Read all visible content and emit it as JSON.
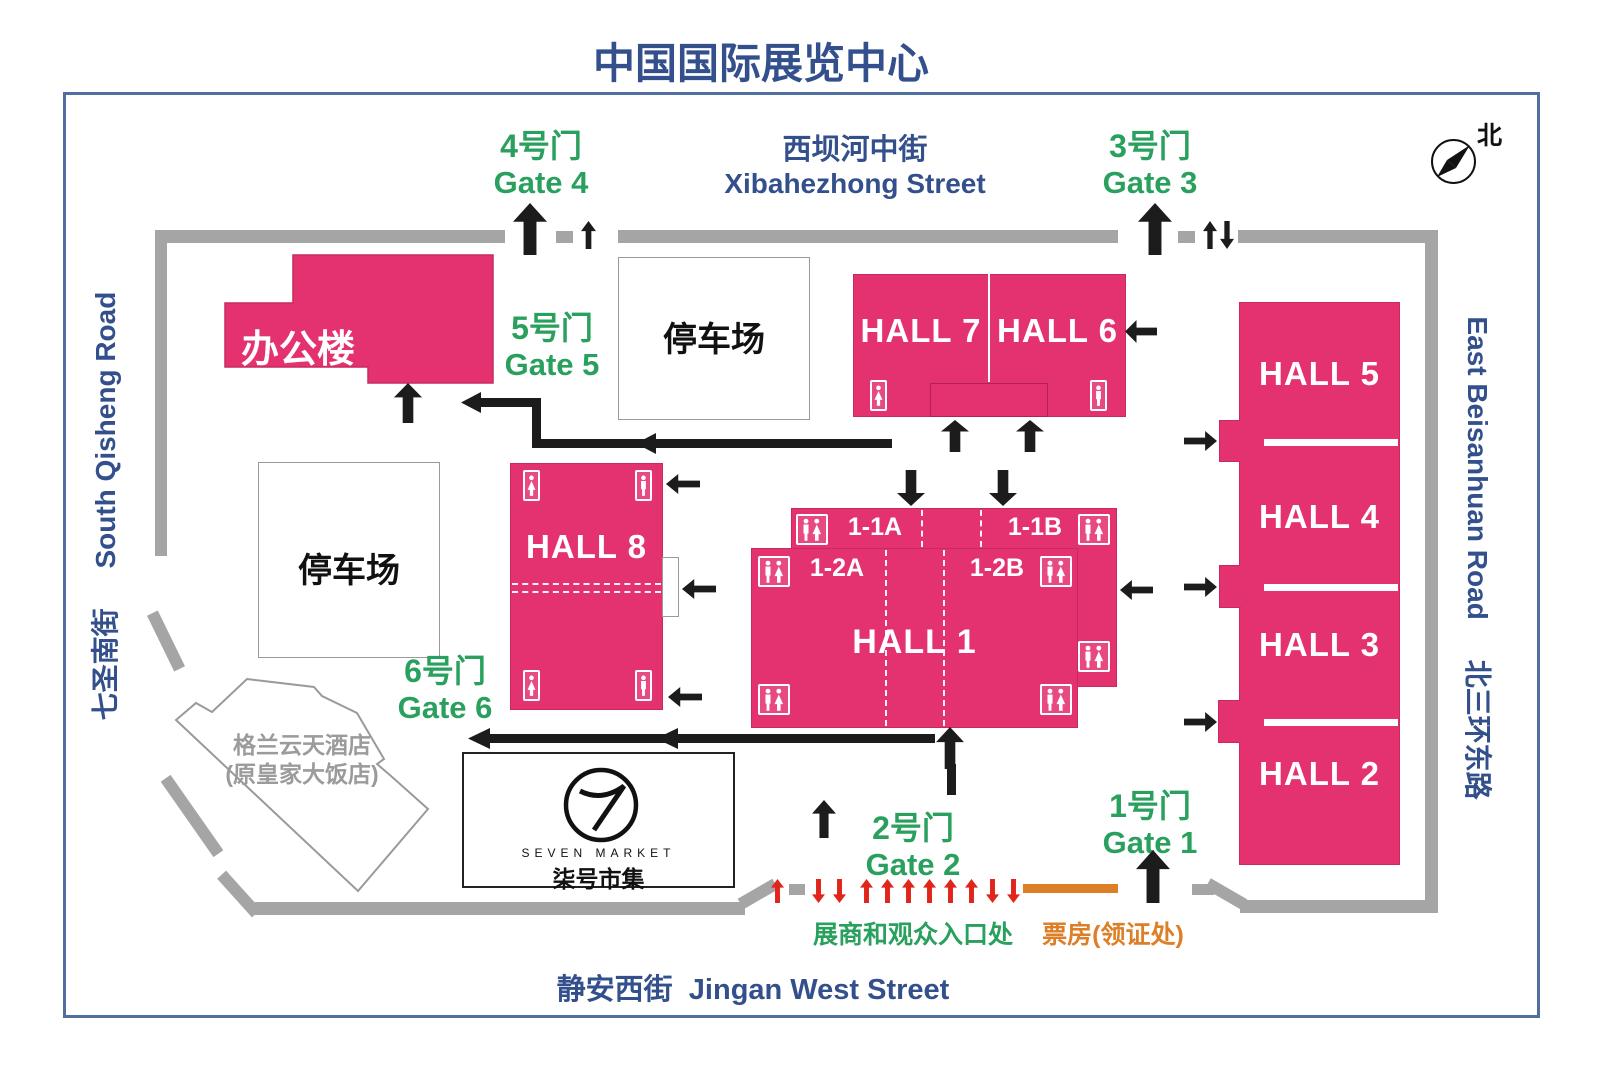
{
  "title": "中国国际展览中心",
  "compass": {
    "north": "北"
  },
  "streets": {
    "top": {
      "zh": "西坝河中街",
      "en": "Xibahezhong Street"
    },
    "bottom": {
      "zh": "静安西街",
      "en": "Jingan West Street"
    },
    "left": {
      "zh": "七圣南街",
      "en": "South Qisheng Road"
    },
    "right": {
      "zh": "北三环东路",
      "en": "East Beisanhuan Road"
    }
  },
  "gates": {
    "g1": {
      "zh": "1号门",
      "en": "Gate 1"
    },
    "g2": {
      "zh": "2号门",
      "en": "Gate 2"
    },
    "g3": {
      "zh": "3号门",
      "en": "Gate 3"
    },
    "g4": {
      "zh": "4号门",
      "en": "Gate 4"
    },
    "g5": {
      "zh": "5号门",
      "en": "Gate 5"
    },
    "g6": {
      "zh": "6号门",
      "en": "Gate 6"
    }
  },
  "halls": {
    "h1": "HALL 1",
    "h2": "HALL 2",
    "h3": "HALL 3",
    "h4": "HALL 4",
    "h5": "HALL 5",
    "h6": "HALL 6",
    "h7": "HALL 7",
    "h8": "HALL 8",
    "s11a": "1-1A",
    "s11b": "1-1B",
    "s12a": "1-2A",
    "s12b": "1-2B"
  },
  "buildings": {
    "office": "办公楼",
    "parking_top": "停车场",
    "parking_left": "停车场",
    "hotel_line1": "格兰云天酒店",
    "hotel_line2": "(原皇家大饭店)",
    "seven_market_en": "SEVEN MARKET",
    "seven_market_zh": "柒号市集"
  },
  "annotations": {
    "entrance": "展商和观众入口处",
    "ticket": "票房(领证处)"
  },
  "colors": {
    "pink": "#e43270",
    "road": "#a5a5a5",
    "blue": "#33508c",
    "green": "#2aa05e",
    "orange": "#dd7f26",
    "red": "#e1251b"
  }
}
